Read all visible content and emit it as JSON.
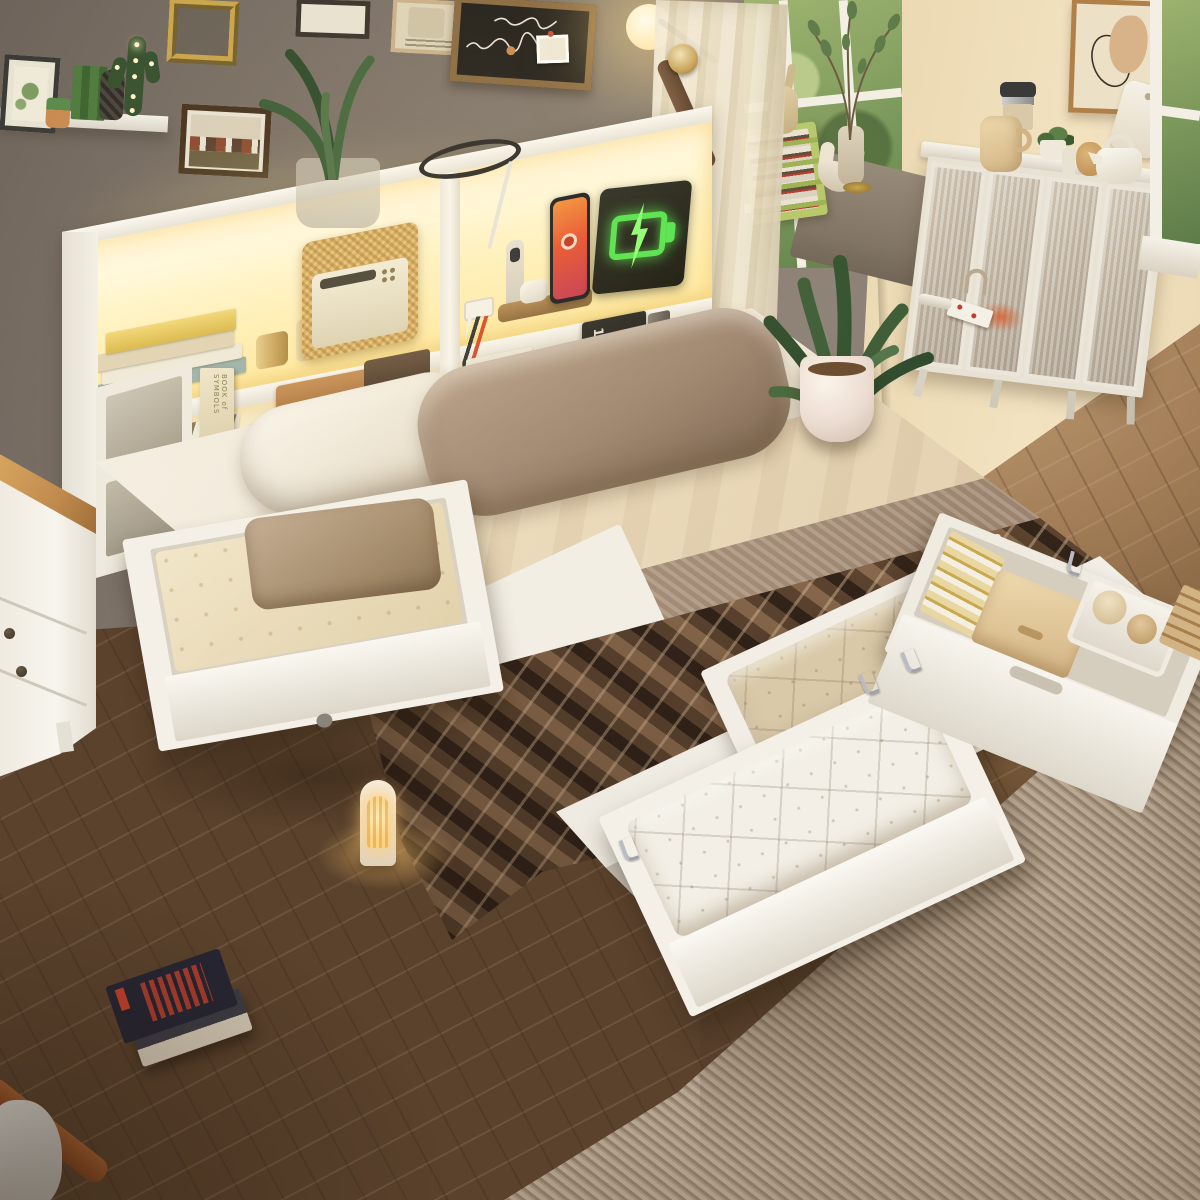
{
  "scene": {
    "type": "furniture product photograph",
    "setting": "warm bedroom, high-angle view",
    "subject": "white queen storage bed with LED-lit bookcase headboard, charging station and open storage drawers",
    "objects": [
      "bookcase headboard with warm LED shelf lighting",
      "wireless charging dock with smartphone, smartwatch stand and earbuds",
      "neon green battery charging sign",
      "rattan speaker radio",
      "stacked books and yarn spools on lit shelf",
      "brown storage boxes and white gift box",
      "white and taupe pillows",
      "cream fitted sheet and knitted throw",
      "dark brown chevron-weave blanket",
      "left pull-out drawer with folded blankets on casters",
      "two open foot drawers with white and beige quilts",
      "right side drawer with toy crate, fabric box and folded linens",
      "open storage cubbies under bed",
      "white nightstand with wood top",
      "arched night light glowing on floor",
      "stack of books on herringbone wood floor",
      "ribbed beige area rug",
      "potted plant in white planter",
      "white sideboard cabinet with fluted glass doors, kettle, grinder, cutting board",
      "gallery wall with frames, chalkboard and cactus marquee light",
      "wall sconce, sheer curtain with tieback, windows with greenery",
      "green desk organizer, wood bunny figurine, ceramic vases on ledge"
    ]
  },
  "text": {
    "box_label": "HE",
    "book_spine_prada": "PRADA",
    "book_spine_1000": "1000",
    "book_symbols": "BOOK of SYMBOLS"
  },
  "palette": {
    "wall_left": "#8a8076",
    "wall_right": "#e3cda4",
    "floor_dark": "#5a422c",
    "floor_light": "#c2a076",
    "rug": "#ab9984",
    "frame_white": "#f6f2ea",
    "led_glow": "#ffeaa2",
    "blanket_dark": "#33241a",
    "blanket_light": "#8a6a4d",
    "sheet_white": "#efe7d6",
    "sheet_cream": "#e9d8ba",
    "knit": "#a18a74",
    "pillow_taupe": "#9c8470",
    "curtain": "#efe5cc",
    "window_green": "#7e9a5e",
    "neon_green": "#55e34f",
    "phone_orange": "#e8512e",
    "wood_top": "#c08a4e",
    "night_glow": "#ffd27e"
  }
}
